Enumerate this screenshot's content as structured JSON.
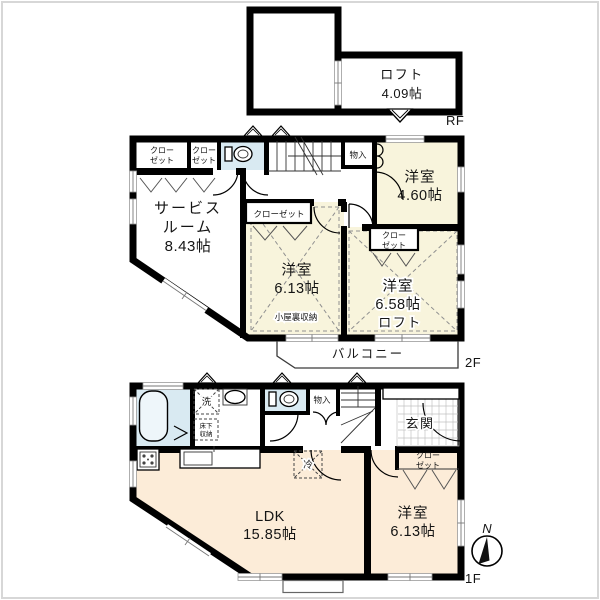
{
  "colors": {
    "wall": "#000000",
    "room_cream": "#f8f4dc",
    "room_peach": "#fcecd8",
    "wet_blue": "#d9eaf2"
  },
  "rf": {
    "loft": {
      "name": "ロフト",
      "size": "4.09帖"
    },
    "floor_label": "RF"
  },
  "f2": {
    "closet_a": {
      "l1": "クロー",
      "l2": "ゼット"
    },
    "closet_b": {
      "l1": "クロー",
      "l2": "ゼット"
    },
    "storage": "物入",
    "room_a": {
      "name": "洋室",
      "size": "4.60帖"
    },
    "service": {
      "l1": "サービス",
      "l2": "ルーム",
      "size": "8.43帖"
    },
    "closet_c": "クローゼット",
    "room_b": {
      "name": "洋室",
      "size": "6.13帖",
      "attic": "小屋裏収納"
    },
    "closet_d": {
      "l1": "クロー",
      "l2": "ゼット"
    },
    "room_c": {
      "name": "洋室",
      "size": "6.58帖",
      "loft": "ロフト"
    },
    "balcony": "バルコニー",
    "floor_label": "2F"
  },
  "f1": {
    "laundry": "洗",
    "underfloor": {
      "l1": "床下",
      "l2": "収納"
    },
    "storage": "物入",
    "entrance": "玄関",
    "closet": {
      "l1": "クロー",
      "l2": "ゼット"
    },
    "ldk": {
      "name": "LDK",
      "size": "15.85帖"
    },
    "room": {
      "name": "洋室",
      "size": "6.13帖"
    },
    "fridge": "冷",
    "compass": "N",
    "floor_label": "1F"
  }
}
